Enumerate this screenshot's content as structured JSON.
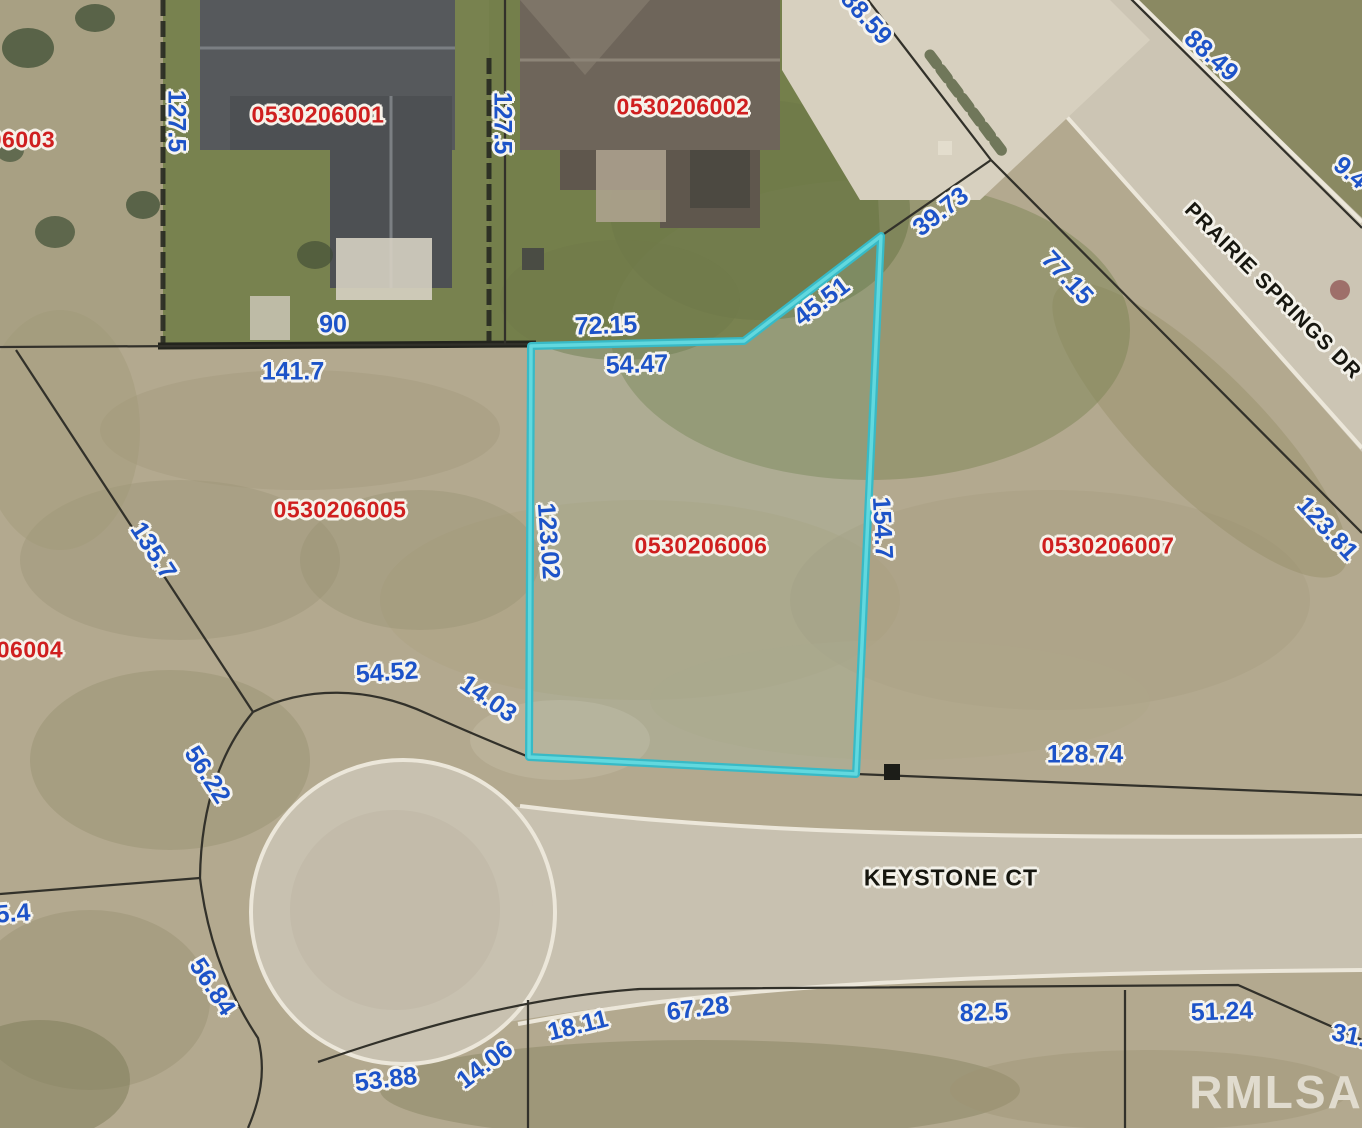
{
  "map": {
    "watermark": "RMLSA",
    "highlight_color": "#3fc6cf",
    "label_colors": {
      "dimension": "#1d53c8",
      "parcel_id": "#cf1f1f",
      "street": "#16160f"
    },
    "streets": [
      {
        "name": "PRAIRIE SPRINGS DR"
      },
      {
        "name": "KEYSTONE CT"
      }
    ],
    "parcels": [
      {
        "id": "06003"
      },
      {
        "id": "0530206001"
      },
      {
        "id": "0530206002"
      },
      {
        "id": "0530206005"
      },
      {
        "id": "0530206006"
      },
      {
        "id": "0530206007"
      },
      {
        "id": "06004"
      }
    ],
    "dimensions": [
      {
        "text": "127.5"
      },
      {
        "text": "127.5"
      },
      {
        "text": "88.59"
      },
      {
        "text": "88.49"
      },
      {
        "text": "9.4"
      },
      {
        "text": "39.73"
      },
      {
        "text": "45.51"
      },
      {
        "text": "77.15"
      },
      {
        "text": "72.15"
      },
      {
        "text": "54.47"
      },
      {
        "text": "90"
      },
      {
        "text": "141.7"
      },
      {
        "text": "135.7"
      },
      {
        "text": "123.02"
      },
      {
        "text": "154.7"
      },
      {
        "text": "123.81"
      },
      {
        "text": "54.52"
      },
      {
        "text": "14.03"
      },
      {
        "text": "56.22"
      },
      {
        "text": "128.74"
      },
      {
        "text": "5.4"
      },
      {
        "text": "56.84"
      },
      {
        "text": "53.88"
      },
      {
        "text": "14.06"
      },
      {
        "text": "18.11"
      },
      {
        "text": "67.28"
      },
      {
        "text": "82.5"
      },
      {
        "text": "51.24"
      },
      {
        "text": "31."
      }
    ]
  }
}
